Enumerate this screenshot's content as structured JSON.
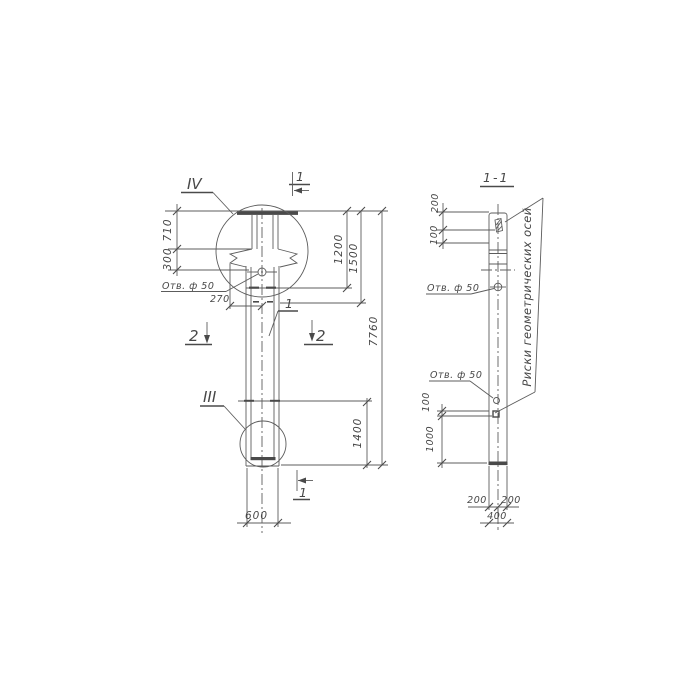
{
  "drawing_title": "Column elevation with section 1-1",
  "left": {
    "labels": {
      "detail_top": "IV",
      "detail_bottom": "III",
      "section_top": "1",
      "section_bottom": "1",
      "cut_left": "2",
      "cut_right": "2",
      "part": "1",
      "hole": "Отв. ф 50"
    },
    "dims": {
      "d710": "710",
      "d300": "300",
      "d270": "270",
      "d1200": "1200",
      "d1500": "1500",
      "d7760": "7760",
      "d1400": "1400",
      "d600": "600"
    }
  },
  "section": {
    "title": "1-1",
    "labels": {
      "hole_top": "Отв. ф 50",
      "hole_bottom": "Отв. ф 50",
      "note": "Риски геометрических осей"
    },
    "dims": {
      "d200_top": "200",
      "d100_top": "100",
      "d100_low": "100",
      "d1000": "1000",
      "d200_bl": "200",
      "d200_br": "200",
      "d400": "400"
    }
  }
}
